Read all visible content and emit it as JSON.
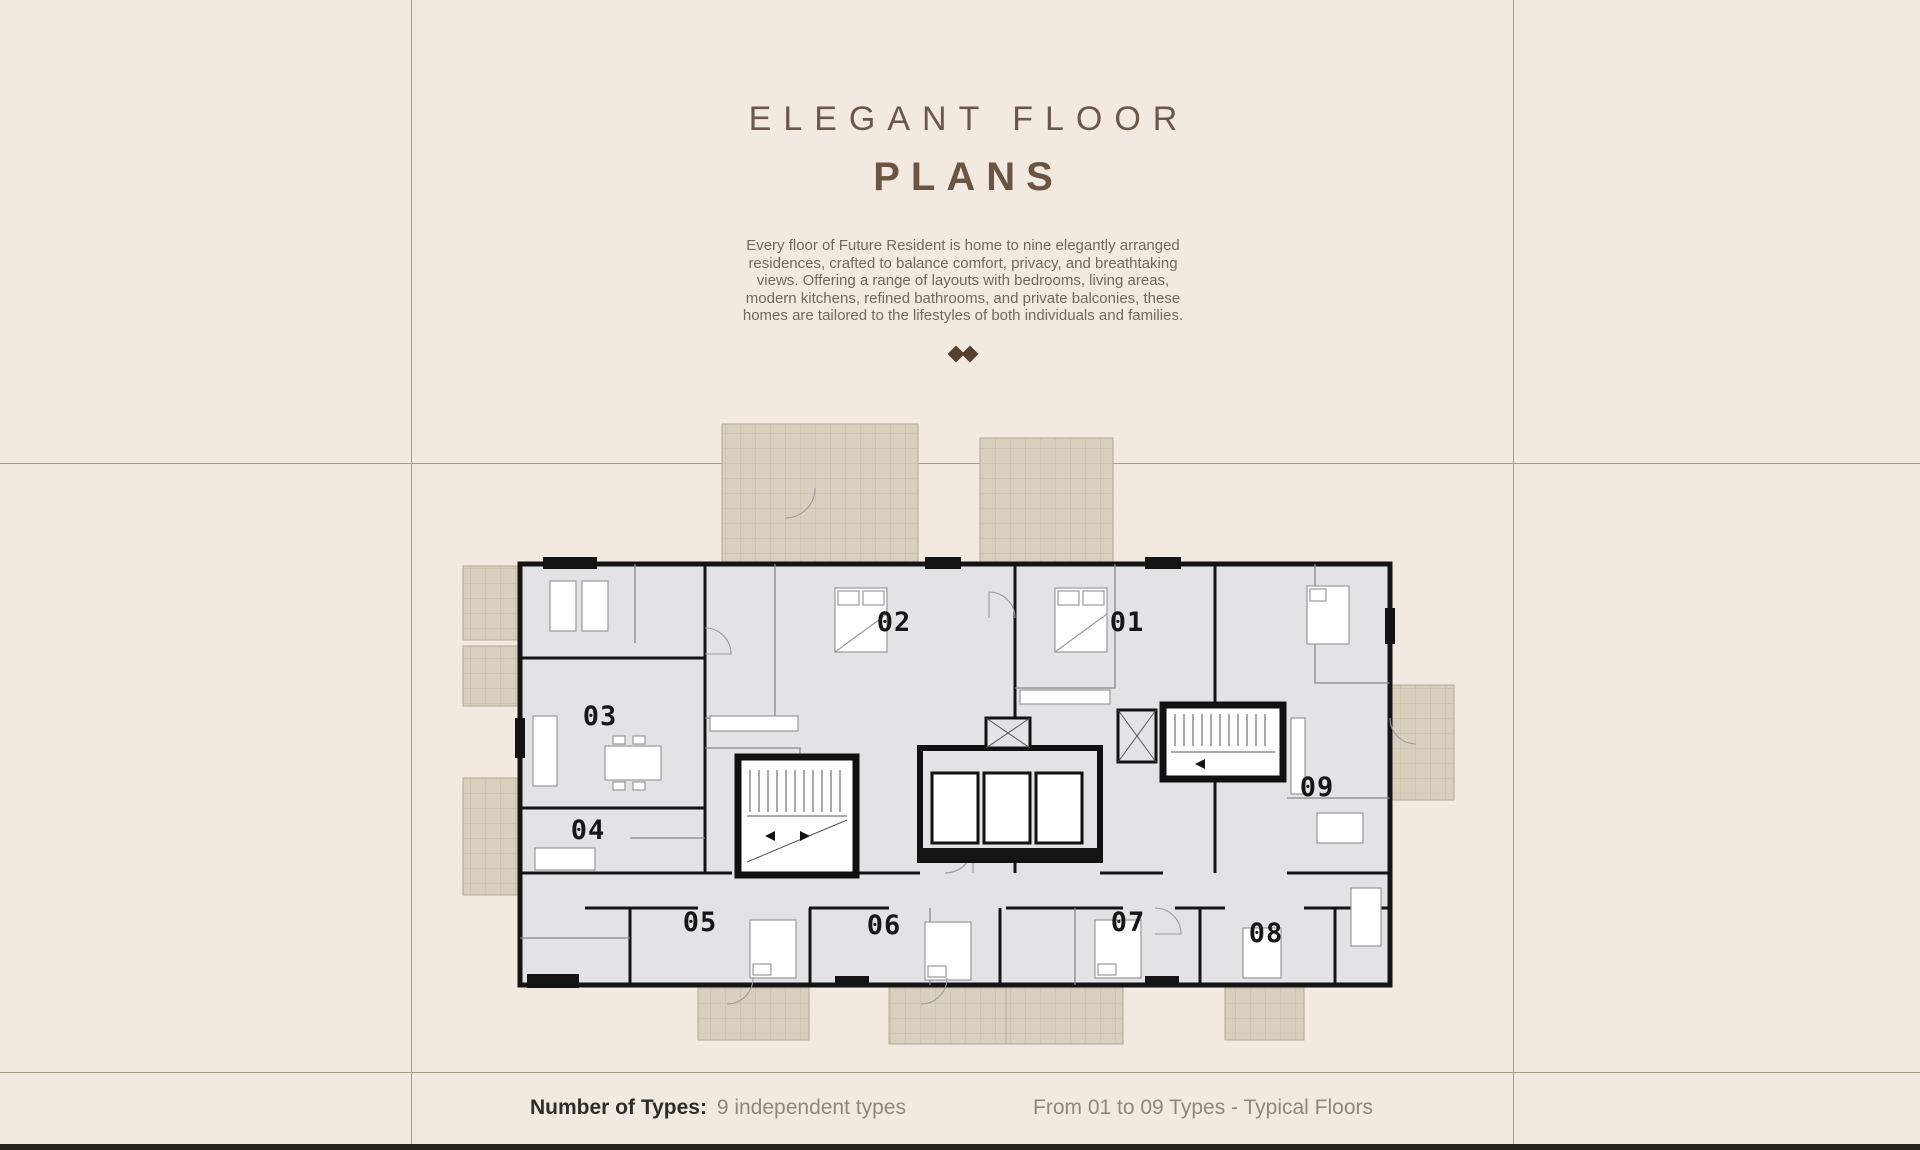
{
  "page": {
    "background": "#f2eae1",
    "rule_color": "#a89d8b",
    "footer_bar_color": "#26221e"
  },
  "header": {
    "title_line1": "ELEGANT FLOOR",
    "title_line2": "PLANS",
    "title_color": "#6a594b",
    "description_lines": [
      "Every floor of Future Resident is home to nine elegantly arranged",
      "residences, crafted to balance comfort, privacy, and breathtaking",
      "views. Offering a range of layouts with bedrooms, living areas,",
      "modern kitchens, refined bathrooms, and private balconies, these",
      "homes are tailored to the lifestyles of both individuals and families."
    ],
    "ornament_icon": "double-diamond-icon",
    "ornament_color": "#54412f"
  },
  "floor_plan": {
    "units": [
      {
        "label": "01",
        "x": 672,
        "y": 213
      },
      {
        "label": "02",
        "x": 439,
        "y": 213
      },
      {
        "label": "03",
        "x": 145,
        "y": 307
      },
      {
        "label": "04",
        "x": 133,
        "y": 421
      },
      {
        "label": "05",
        "x": 245,
        "y": 513
      },
      {
        "label": "06",
        "x": 429,
        "y": 516
      },
      {
        "label": "07",
        "x": 673,
        "y": 513
      },
      {
        "label": "08",
        "x": 811,
        "y": 524
      },
      {
        "label": "09",
        "x": 862,
        "y": 378
      }
    ],
    "colors": {
      "floor": "#e3e3e5",
      "wall": "#141414",
      "partition": "#88888b",
      "furniture": "#9a9a9c",
      "balcony_fill": "#d9cfbe",
      "balcony_line": "#b3a896"
    }
  },
  "footer": {
    "types_label": "Number of Types:",
    "types_value": "9 independent types",
    "right_text": "From 01 to 09 Types - Typical Floors"
  }
}
